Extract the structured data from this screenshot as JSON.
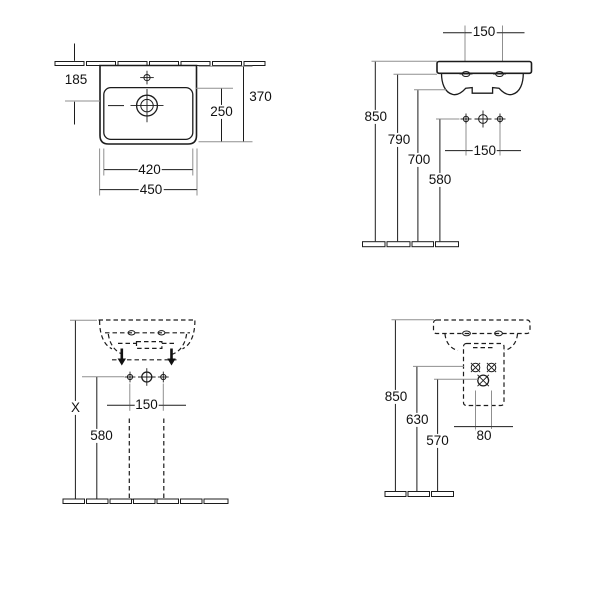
{
  "drawing": {
    "background": "#ffffff",
    "line_color": "#1c1c1c",
    "extension_line_color": "#8f8f8f",
    "text_color": "#111111"
  },
  "views": {
    "front": {
      "d185": "185",
      "d370": "370",
      "d250": "250",
      "d420": "420",
      "d450": "450"
    },
    "side": {
      "d150_faucet": "150",
      "d850": "850",
      "d790": "790",
      "d700": "700",
      "d580": "580",
      "d150_holes": "150"
    },
    "front_pedestal": {
      "dX": "X",
      "d580": "580",
      "d150": "150"
    },
    "side_pedestal": {
      "d850": "850",
      "d630": "630",
      "d570": "570",
      "d80": "80"
    }
  }
}
